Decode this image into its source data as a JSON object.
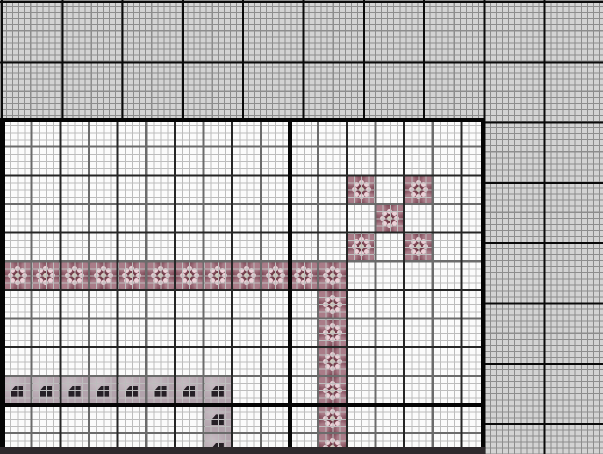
{
  "app": {
    "view": "cross-stitch-pattern-canvas",
    "visible_text": ""
  },
  "canvas": {
    "width_px": 603,
    "height_px": 454,
    "fabric": {
      "background": "#d3d3d3",
      "fine_grid_color": "#8d8d8d",
      "fine_cell_px": 6.05,
      "major_line_color": "#0a0a0a",
      "major_line_every_px": 60.3,
      "cells_per_major": 10
    },
    "pattern_area": {
      "left_px": 0,
      "top_px": 118,
      "width_px": 485,
      "height_px": 336,
      "background": "#fbfbfb",
      "thread_grid_color": "#bdbdbd",
      "thread_cell_px": 7.1625,
      "stitch_cell_px": 28.65,
      "stitch_origin_x_px": 3,
      "stitch_line_color": "#6b6b6b",
      "double_stitch_line_color": "#262626",
      "major_line_color": "#050505",
      "bottom_band_color": "#2e292c"
    }
  },
  "palette": [
    {
      "id": "flower",
      "name": "dark-red-floss",
      "fill": "#5c2130",
      "symbol_icon": "flower-dots-icon",
      "symbol_petal_color": "#ecd2d8",
      "symbol_center_color": "#d9d2c2"
    },
    {
      "id": "half",
      "name": "mauve-gray-floss",
      "fill": "#b2a3ac",
      "symbol_icon": "corner-cut-square-icon",
      "symbol_color": "#262026"
    }
  ],
  "chart_data": {
    "type": "heatmap",
    "title": "",
    "stitch_grid_cols": 17,
    "stitch_grid_rows": 12,
    "flower_cells": [
      [
        0,
        5
      ],
      [
        1,
        5
      ],
      [
        2,
        5
      ],
      [
        3,
        5
      ],
      [
        4,
        5
      ],
      [
        5,
        5
      ],
      [
        6,
        5
      ],
      [
        7,
        5
      ],
      [
        8,
        5
      ],
      [
        9,
        5
      ],
      [
        10,
        5
      ],
      [
        11,
        5
      ],
      [
        11,
        6
      ],
      [
        11,
        7
      ],
      [
        11,
        8
      ],
      [
        11,
        9
      ],
      [
        11,
        10
      ],
      [
        11,
        11
      ],
      [
        12,
        2
      ],
      [
        14,
        2
      ],
      [
        13,
        3
      ],
      [
        12,
        4
      ],
      [
        14,
        4
      ]
    ],
    "half_cells": [
      [
        0,
        9
      ],
      [
        1,
        9
      ],
      [
        2,
        9
      ],
      [
        3,
        9
      ],
      [
        4,
        9
      ],
      [
        5,
        9
      ],
      [
        6,
        9
      ],
      [
        7,
        9
      ],
      [
        7,
        10
      ],
      [
        7,
        11
      ]
    ]
  }
}
